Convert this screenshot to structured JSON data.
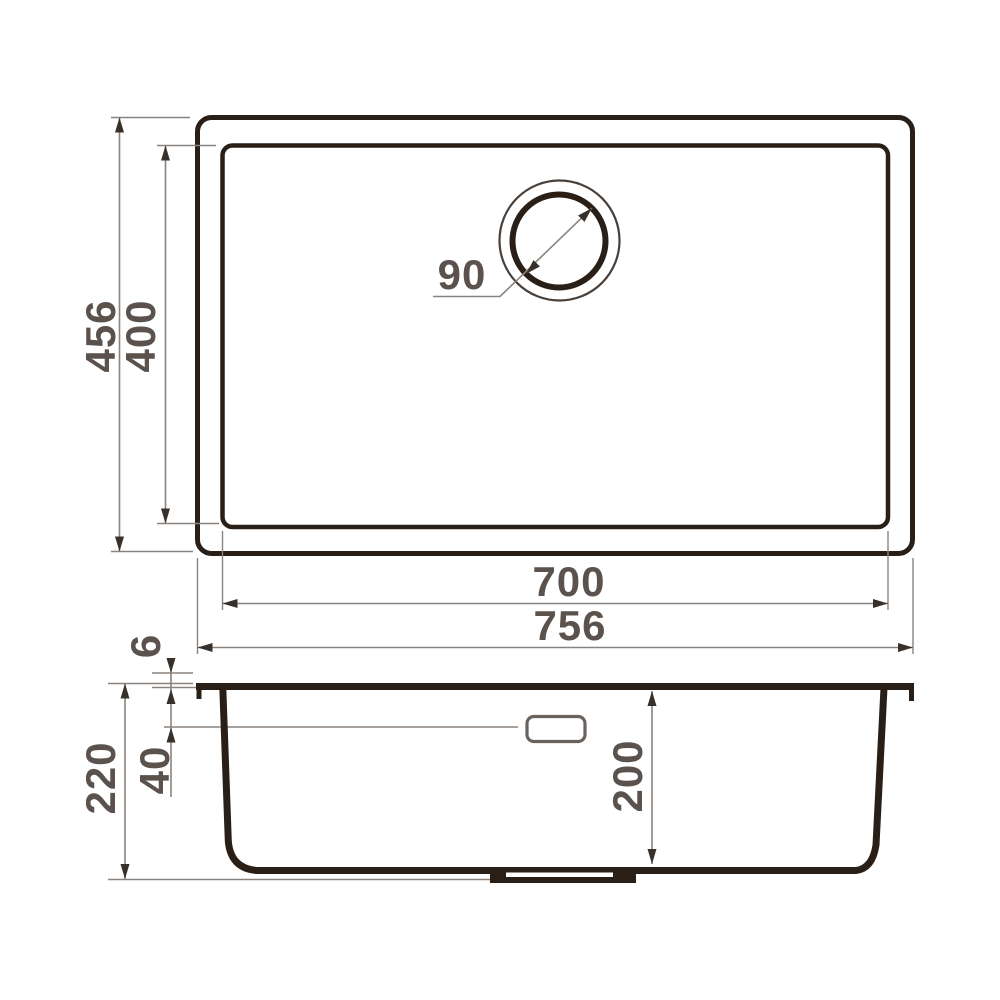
{
  "drawing": {
    "subject": "rectangular undermount kitchen sink technical dimension drawing",
    "views": [
      "top view",
      "cross-section view"
    ],
    "units": "mm"
  },
  "top_view": {
    "overall_width": "756",
    "bowl_width": "700",
    "overall_depth": "456",
    "bowl_depth": "400",
    "drain_diameter": "90"
  },
  "section_view": {
    "overall_height": "220",
    "bowl_inner_depth": "200",
    "overflow_drop": "40",
    "rim_thickness": "6"
  },
  "colors": {
    "outline": "#291f17",
    "dim_line": "#8b847e",
    "arrow": "#38302a",
    "text": "#5b524d",
    "background": "#ffffff",
    "circle_thin": "#4a403a",
    "overflow": "#6a625c"
  }
}
